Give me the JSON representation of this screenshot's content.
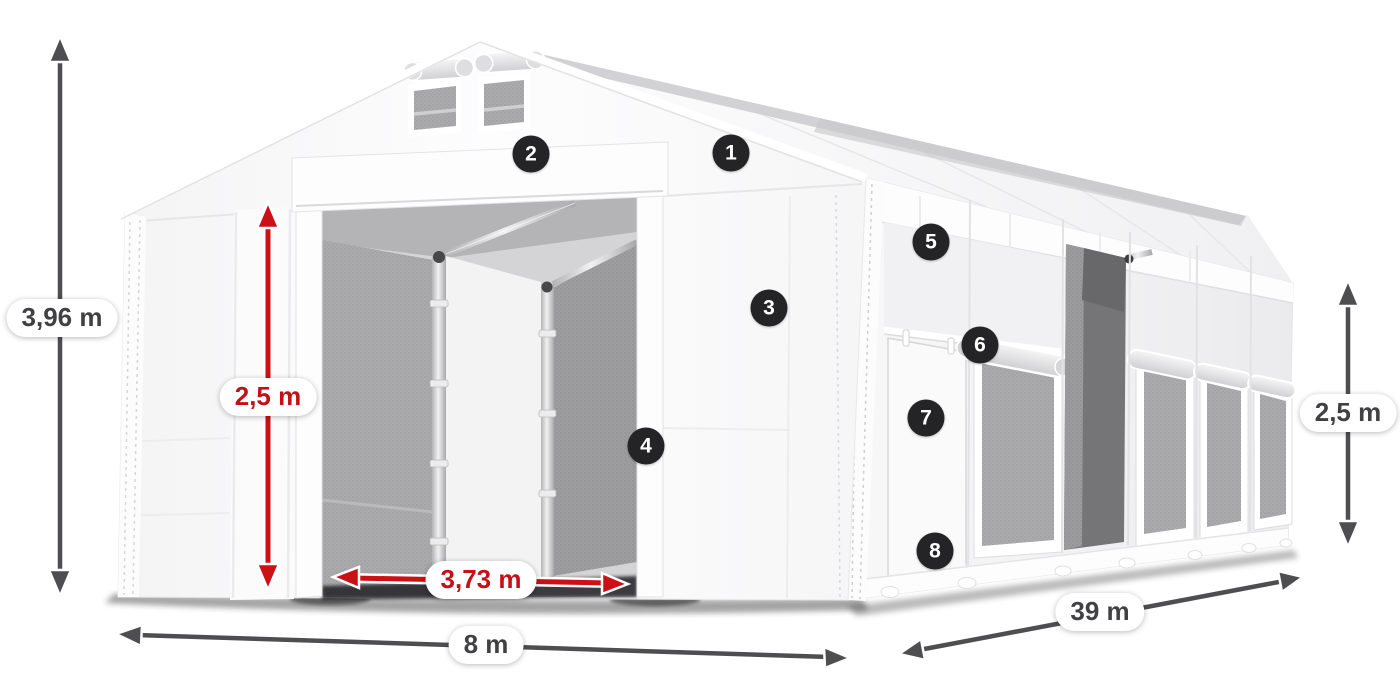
{
  "diagram": {
    "subject": "storage-tent-dimension-diagram"
  },
  "dimensions": {
    "total_height": "3,96 m",
    "entrance_height": "2,5 m",
    "entrance_width": "3,73 m",
    "front_width": "8 m",
    "side_length": "39 m",
    "side_wall_height": "2,5 m"
  },
  "callouts": {
    "c1": "1",
    "c2": "2",
    "c3": "3",
    "c4": "4",
    "c5": "5",
    "c6": "6",
    "c7": "7",
    "c8": "8"
  },
  "colors": {
    "arrow_dark": "#4e4e51",
    "arrow_red": "#cb1016",
    "label_dark": "#414144",
    "label_red": "#c41117",
    "badge_bg": "#242426",
    "badge_text": "#ffffff",
    "canvas_bg": "#ffffff"
  }
}
